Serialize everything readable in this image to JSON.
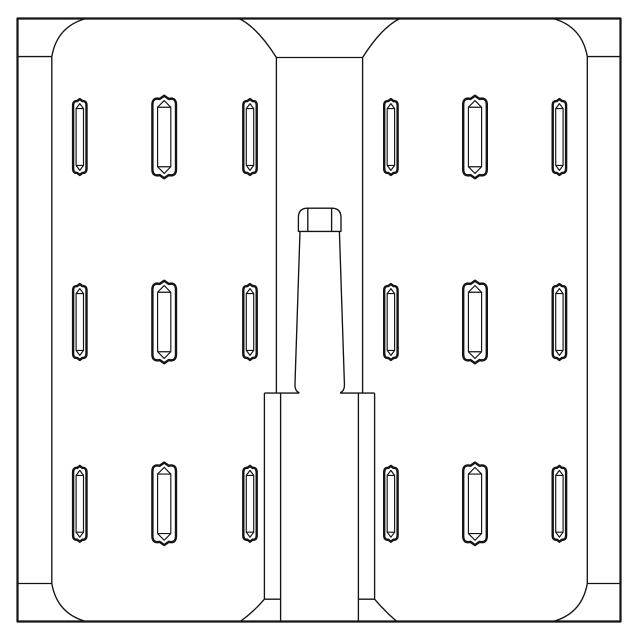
{
  "meta": {
    "title": "Slotted twin-panel mold plate - front view technical drawing",
    "background_color": "#ffffff",
    "line_color": "#141414"
  },
  "drawing": {
    "canvas": {
      "width": 640,
      "height": 640
    },
    "strokes": {
      "frame": 2.2,
      "outline": 1.35,
      "slot_outer": 2.4,
      "slot_inner": 1.15
    },
    "frame": {
      "x": 17.5,
      "y": 18.5,
      "width": 603,
      "height": 603
    },
    "paths": [
      {
        "name": "left-panel-edge",
        "stroke": "outline",
        "d": "M51.8,56.6 L51.8,583.5"
      },
      {
        "name": "left-panel-top-crease",
        "stroke": "outline",
        "d": "M17.5,56.6 L51.8,56.6"
      },
      {
        "name": "left-panel-bottom-crease",
        "stroke": "outline",
        "d": "M17.5,583.5 L51.8,583.5"
      },
      {
        "name": "left-panel-top-corner",
        "stroke": "outline",
        "d": "M51.8,56.6 Q57,26.5 86,18.5"
      },
      {
        "name": "left-panel-bottom-corner",
        "stroke": "outline",
        "d": "M51.8,583.5 Q57,613.5 86,621.5"
      },
      {
        "name": "right-panel-edge",
        "stroke": "outline",
        "d": "M587.3,56.6 L587.3,583.5"
      },
      {
        "name": "right-panel-top-crease",
        "stroke": "outline",
        "d": "M587.3,56.6 L620.5,56.6"
      },
      {
        "name": "right-panel-bottom-crease",
        "stroke": "outline",
        "d": "M587.3,583.5 L620.5,583.5"
      },
      {
        "name": "right-panel-top-corner",
        "stroke": "outline",
        "d": "M587.3,56.6 Q582,26.5 553,18.5"
      },
      {
        "name": "right-panel-bottom-corner",
        "stroke": "outline",
        "d": "M587.3,583.5 Q582,613.5 553,621.5"
      },
      {
        "name": "channel-left-wall",
        "stroke": "outline",
        "d": "M276.4,57.5 L276.4,393.1"
      },
      {
        "name": "channel-right-wall",
        "stroke": "outline",
        "d": "M362.6,57.5 L362.6,393.1"
      },
      {
        "name": "channel-top-edge",
        "stroke": "outline",
        "d": "M276.4,57.5 L362.6,57.5"
      },
      {
        "name": "channel-left-flare",
        "stroke": "outline",
        "d": "M239,18.5 Q257.5,27.5 276.4,57.5"
      },
      {
        "name": "channel-right-flare",
        "stroke": "outline",
        "d": "M400,18.5 Q381.5,27.5 362.6,57.5"
      },
      {
        "name": "sprue-cap-outline",
        "stroke": "outline",
        "d": "M298.4,231.4 L298.4,217.5 Q298.4,208.2 307.8,208.2 L331.6,208.2 Q341,208.2 341,217.5 L341,231.4 Z"
      },
      {
        "name": "sprue-cap-left-tangent",
        "stroke": "outline",
        "d": "M307.8,208.2 L307.8,231.4"
      },
      {
        "name": "sprue-cap-right-tangent",
        "stroke": "outline",
        "d": "M331.6,208.2 L331.6,231.4"
      },
      {
        "name": "sprue-left-side",
        "stroke": "outline",
        "d": "M300,231.4 L295,383.5 Q294.5,391.2 299.3,392.8"
      },
      {
        "name": "sprue-right-side",
        "stroke": "outline",
        "d": "M339.4,231.4 L344.4,383.5 Q344.9,391.2 340.1,392.8"
      },
      {
        "name": "step-left-edge",
        "stroke": "outline",
        "d": "M264.4,393.1 L299.3,393.1"
      },
      {
        "name": "step-right-edge",
        "stroke": "outline",
        "d": "M340.1,393.1 L374.6,393.1"
      },
      {
        "name": "boss-left-wall",
        "stroke": "outline",
        "d": "M264.4,393.1 L264.4,599.2"
      },
      {
        "name": "boss-right-wall",
        "stroke": "outline",
        "d": "M374.6,393.1 L374.6,599.2"
      },
      {
        "name": "boss-bottom-left-crease",
        "stroke": "outline",
        "d": "M264.4,599.2 L280.6,599.2"
      },
      {
        "name": "boss-bottom-right-crease",
        "stroke": "outline",
        "d": "M358.4,599.2 L374.6,599.2"
      },
      {
        "name": "boss-left-chamfer",
        "stroke": "outline",
        "d": "M264.4,599.2 Q254,611.5 240.2,621.5"
      },
      {
        "name": "boss-right-chamfer",
        "stroke": "outline",
        "d": "M374.6,599.2 Q385,611.5 396.8,621.5"
      },
      {
        "name": "sprue-lower-left-side",
        "stroke": "outline",
        "d": "M280.6,393.1 L280.6,621.5"
      },
      {
        "name": "sprue-lower-right-side",
        "stroke": "outline",
        "d": "M358.4,393.1 L358.4,621.5"
      }
    ],
    "slot_styles": {
      "narrow": {
        "w": 13.4,
        "h": 75.8,
        "r": 6.5,
        "apex_w": 2.6,
        "apex_drop": 2.0,
        "inset": 3.0,
        "end_inset": 9.5,
        "v_apex": 4.5
      },
      "wide": {
        "w": 23.6,
        "h": 82.5,
        "r": 9.0,
        "apex_w": 4.5,
        "apex_drop": 3.2,
        "inset": 5.2,
        "end_inset": 11.5,
        "v_apex": 4.8
      }
    },
    "slots": [
      {
        "cx": 79.8,
        "cy": 137,
        "style": "narrow"
      },
      {
        "cx": 164.2,
        "cy": 137,
        "style": "wide"
      },
      {
        "cx": 250,
        "cy": 137,
        "style": "narrow"
      },
      {
        "cx": 390.9,
        "cy": 137,
        "style": "narrow"
      },
      {
        "cx": 475,
        "cy": 137,
        "style": "wide"
      },
      {
        "cx": 559.4,
        "cy": 137,
        "style": "narrow"
      },
      {
        "cx": 79.8,
        "cy": 322,
        "style": "narrow"
      },
      {
        "cx": 164.2,
        "cy": 322,
        "style": "wide"
      },
      {
        "cx": 250,
        "cy": 322,
        "style": "narrow"
      },
      {
        "cx": 390.9,
        "cy": 322,
        "style": "narrow"
      },
      {
        "cx": 475,
        "cy": 322,
        "style": "wide"
      },
      {
        "cx": 559.4,
        "cy": 322,
        "style": "narrow"
      },
      {
        "cx": 79.8,
        "cy": 503.8,
        "style": "narrow"
      },
      {
        "cx": 164.2,
        "cy": 503.8,
        "style": "wide"
      },
      {
        "cx": 250,
        "cy": 503.8,
        "style": "narrow"
      },
      {
        "cx": 390.9,
        "cy": 503.8,
        "style": "narrow"
      },
      {
        "cx": 475,
        "cy": 503.8,
        "style": "wide"
      },
      {
        "cx": 559.4,
        "cy": 503.8,
        "style": "narrow"
      }
    ]
  }
}
